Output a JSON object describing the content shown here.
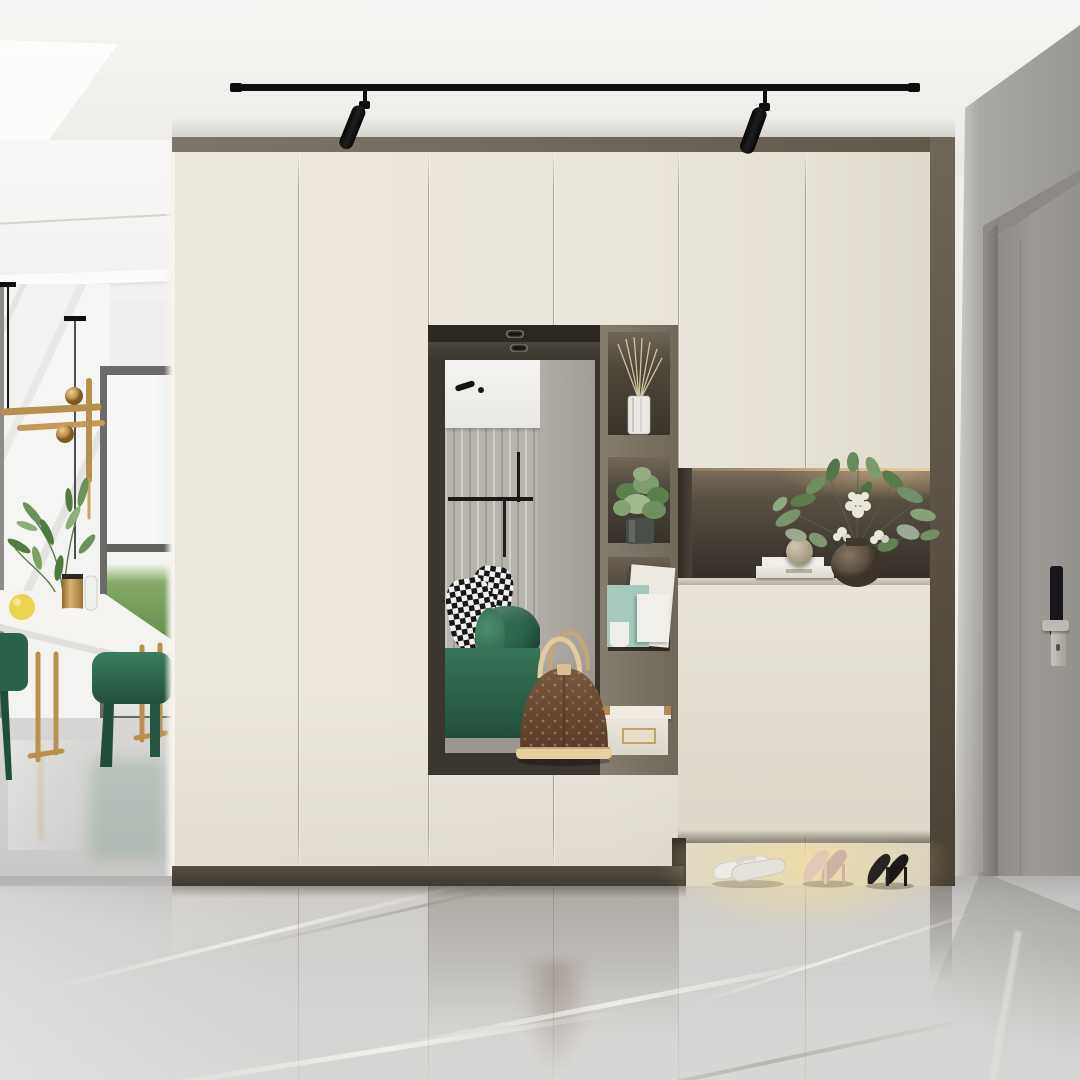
{
  "description": "Modern entryway interior: floor-to-ceiling cream wardrobe with mirrored dressing nook, open display shelves, lit display niche, floating shoe cabinet with warm under-light, gray entry door with smart lock, polished gray marble floor, and a dining corner with green velvet stools and brass pendant.",
  "palette": {
    "ceiling": "#f2f1ee",
    "cabinet_cream": "#ebe6db",
    "cabinet_top_band": "#6f6859",
    "frame_dark": "#3a352e",
    "bench": "#8b8377",
    "niche_back": "#48413a",
    "accent_green": "#2e6a50",
    "brass": "#b98f4e",
    "bag_brown": "#6b4936",
    "bag_trim": "#e2cba0",
    "teal_box": "#a5cabd",
    "under_cabinet_glow": "#ecd9a4",
    "wall_gray": "#a9a7a3",
    "door_gray": "#98958f",
    "floor_gray": "#cccbc9",
    "marble_vein": "#e9e8e6",
    "heel_nude": "#d5bda9",
    "heel_black": "#211f1d",
    "slipper_white": "#eae8e2"
  },
  "scene": {
    "ceiling": {
      "track_light": {
        "rail_color": "#101010",
        "spotlight_count": 2
      }
    },
    "dining_area": {
      "items": [
        "white marble dining table",
        "brass sled table legs",
        "green velvet stools",
        "brass linear pendant lamp",
        "olive branch in brass vase",
        "glass bottle",
        "lemon",
        "full-height window with lawn view",
        "sheer marble-veined wall panel"
      ]
    },
    "wardrobe": {
      "color": "#ebe6db",
      "door_panel_count": 8,
      "drawer_count": 2
    },
    "mirror_nook": {
      "spotlight_count": 2,
      "reflection_items": [
        "white ceiling",
        "gray curtain",
        "clothes rail",
        "houndstooth pillows",
        "green bolster cushion",
        "green bed"
      ],
      "bench_item": "brown monogram handbag with cream handles"
    },
    "shelf_column": {
      "compartments": [
        "reed diffuser in white vase",
        "green plant in glass pot",
        "teal and white gift boxes",
        "white storage box with brass corners"
      ]
    },
    "display_niche": {
      "lighting": "warm LED strip",
      "items": [
        "stack of white books",
        "speckled decor sphere",
        "textured round vase with white hydrangea and eucalyptus"
      ]
    },
    "shoe_cabinet": {
      "under_light": "#ecd9a4",
      "shoes": [
        "white slippers",
        "beige high heels",
        "black high heels"
      ]
    },
    "entry_door": {
      "color": "#98958f",
      "smart_lock": {
        "body": "#17161a",
        "lever": "#bdbab4"
      }
    },
    "floor": {
      "material": "polished gray marble",
      "color": "#cccbc9"
    }
  }
}
